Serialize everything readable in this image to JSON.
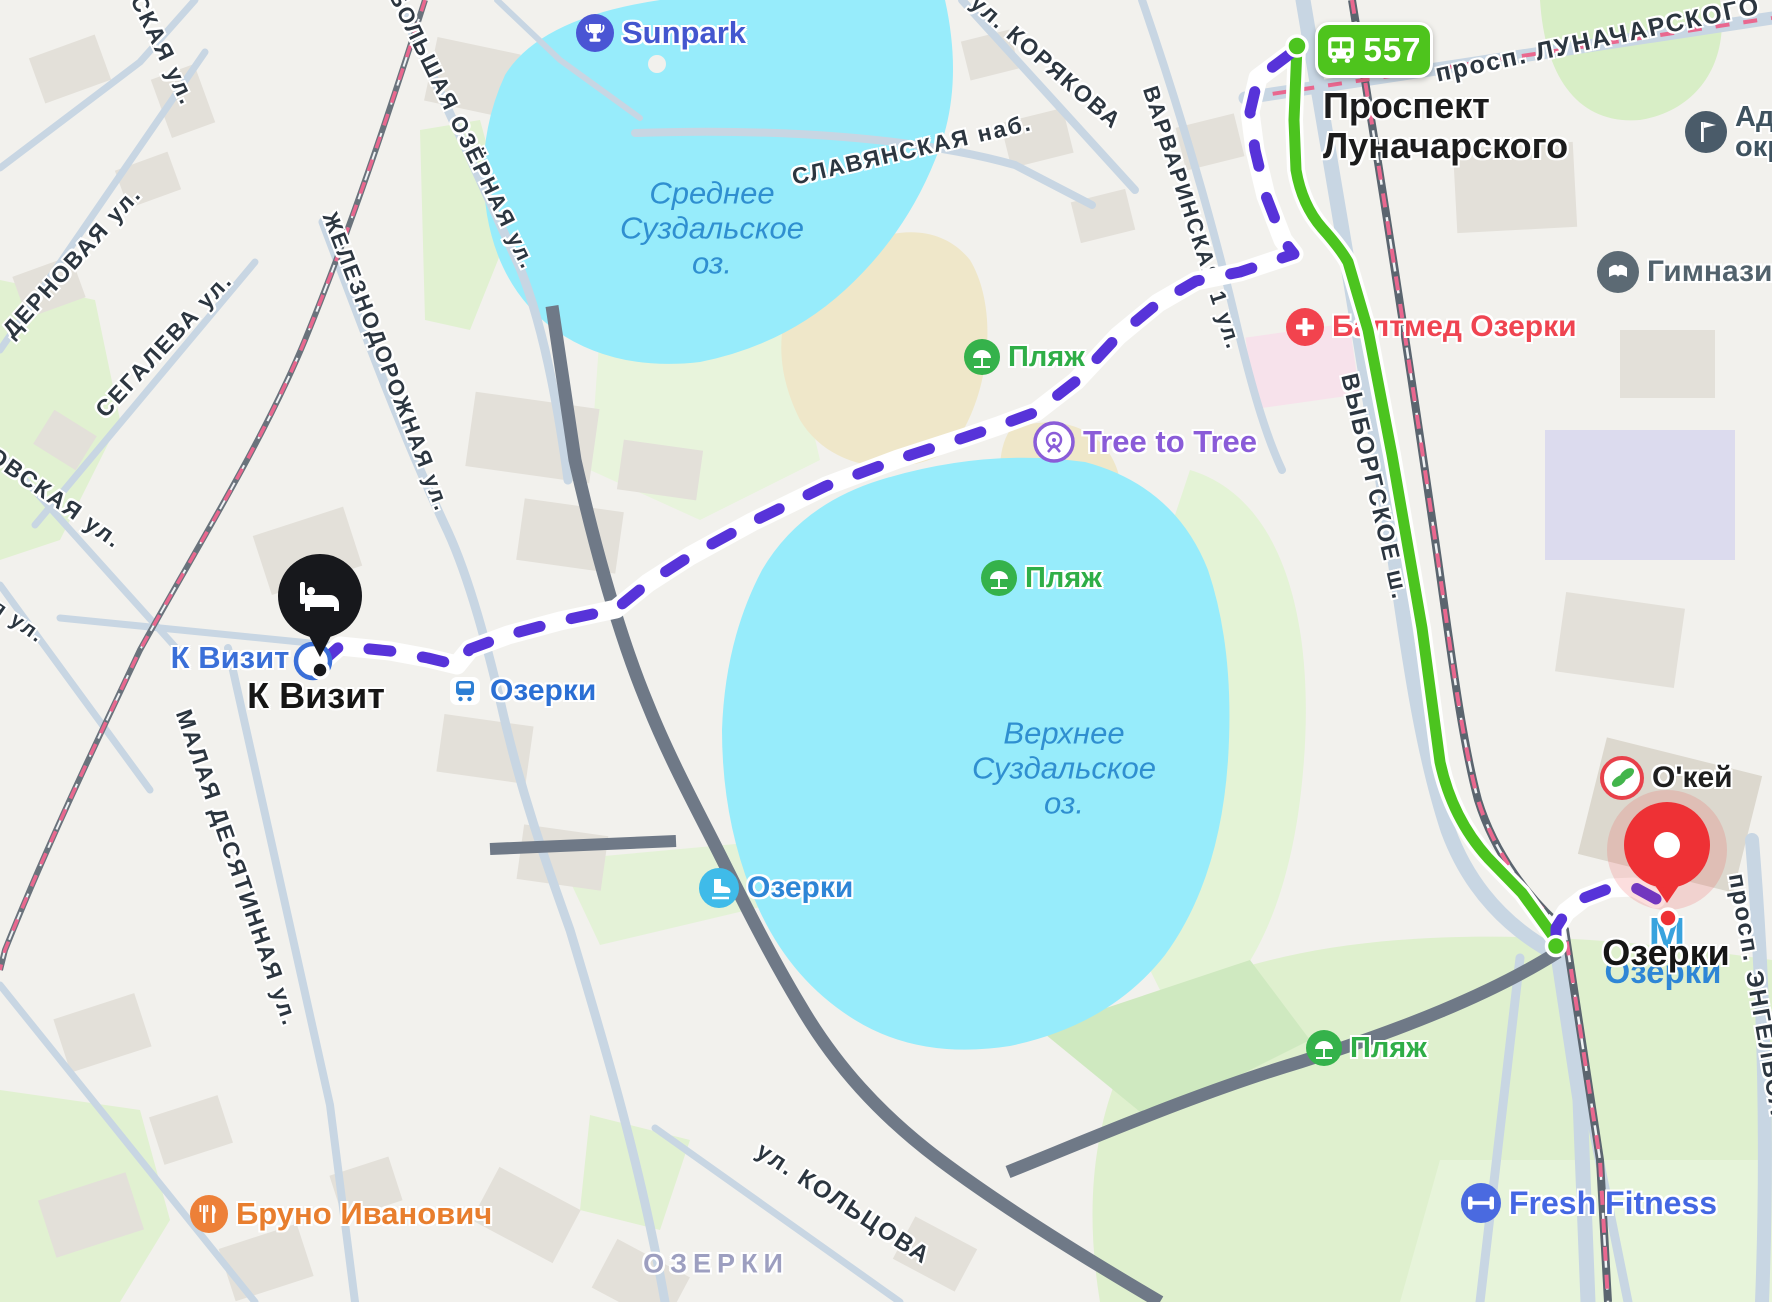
{
  "transit": {
    "bus_route": "557"
  },
  "stops": {
    "origin_line1": "Проспект",
    "origin_line2": "Луначарского"
  },
  "destination": {
    "name": "К Визит"
  },
  "metro": {
    "name": "Озерки",
    "station_text": "Озерки",
    "m": "М"
  },
  "lakes": {
    "middle": {
      "line1": "Среднее",
      "line2": "Суздальское",
      "line3": "оз."
    },
    "upper": {
      "line1": "Верхнее",
      "line2": "Суздальское",
      "line3": "оз."
    }
  },
  "pois": {
    "sunpark": "Sunpark",
    "tree_to_tree": "Tree to Tree",
    "beach": "Пляж",
    "baltmed": "Балтмед Озерки",
    "admin_line1": "Ад",
    "admin_line2": "окр",
    "gymnasium": "Гимнази",
    "okey": "О'кей",
    "fresh_fitness": "Fresh Fitness",
    "bruno": "Бруно Иванович",
    "ozerki_rail": "Озерки",
    "ozerki_rink": "Озерки",
    "k_vizit": "К Визит"
  },
  "streets": {
    "prosp_lunacharskogo": "просп. ЛУНАЧАРСКОГО",
    "vyborgskoe": "ВЫБОРГСКОЕ ш.",
    "prosp_engelsa": "просп. ЭНГЕЛЬСА",
    "koryakova": "ул. КОРЯКОВА",
    "slavyanskaya": "СЛАВЯНСКАЯ наб.",
    "varvarinskaya": "ВАРВАРИНСКАЯ 1 ул.",
    "bolshaya_ozernaya": "БОЛЬШАЯ ОЗЁРНАЯ ул.",
    "zheleznodorozhnaya": "ЖЕЛЕЗНОДОРОЖНАЯ ул.",
    "malaya_desyatinnaya": "МАЛАЯ ДЕСЯТИННАЯ ул.",
    "koltsova": "ул. КОЛЬЦОВА",
    "segaleva": "СЕГАЛЕВА ул.",
    "dernovaya": "ДЕРНОВАЯ ул.",
    "skaya": "СКАЯ ул.",
    "ovskaya": "ОВСКАЯ ул.",
    "ya": "я ул."
  },
  "district": {
    "ozerki": "ОЗЕРКИ"
  },
  "colors": {
    "route_green": "#4cc41f",
    "route_purple": "#5733d9",
    "marker_red": "#ee3135",
    "marker_black": "#17181c",
    "water": "#97ecfb",
    "bus_badge": "#4ec41d"
  }
}
